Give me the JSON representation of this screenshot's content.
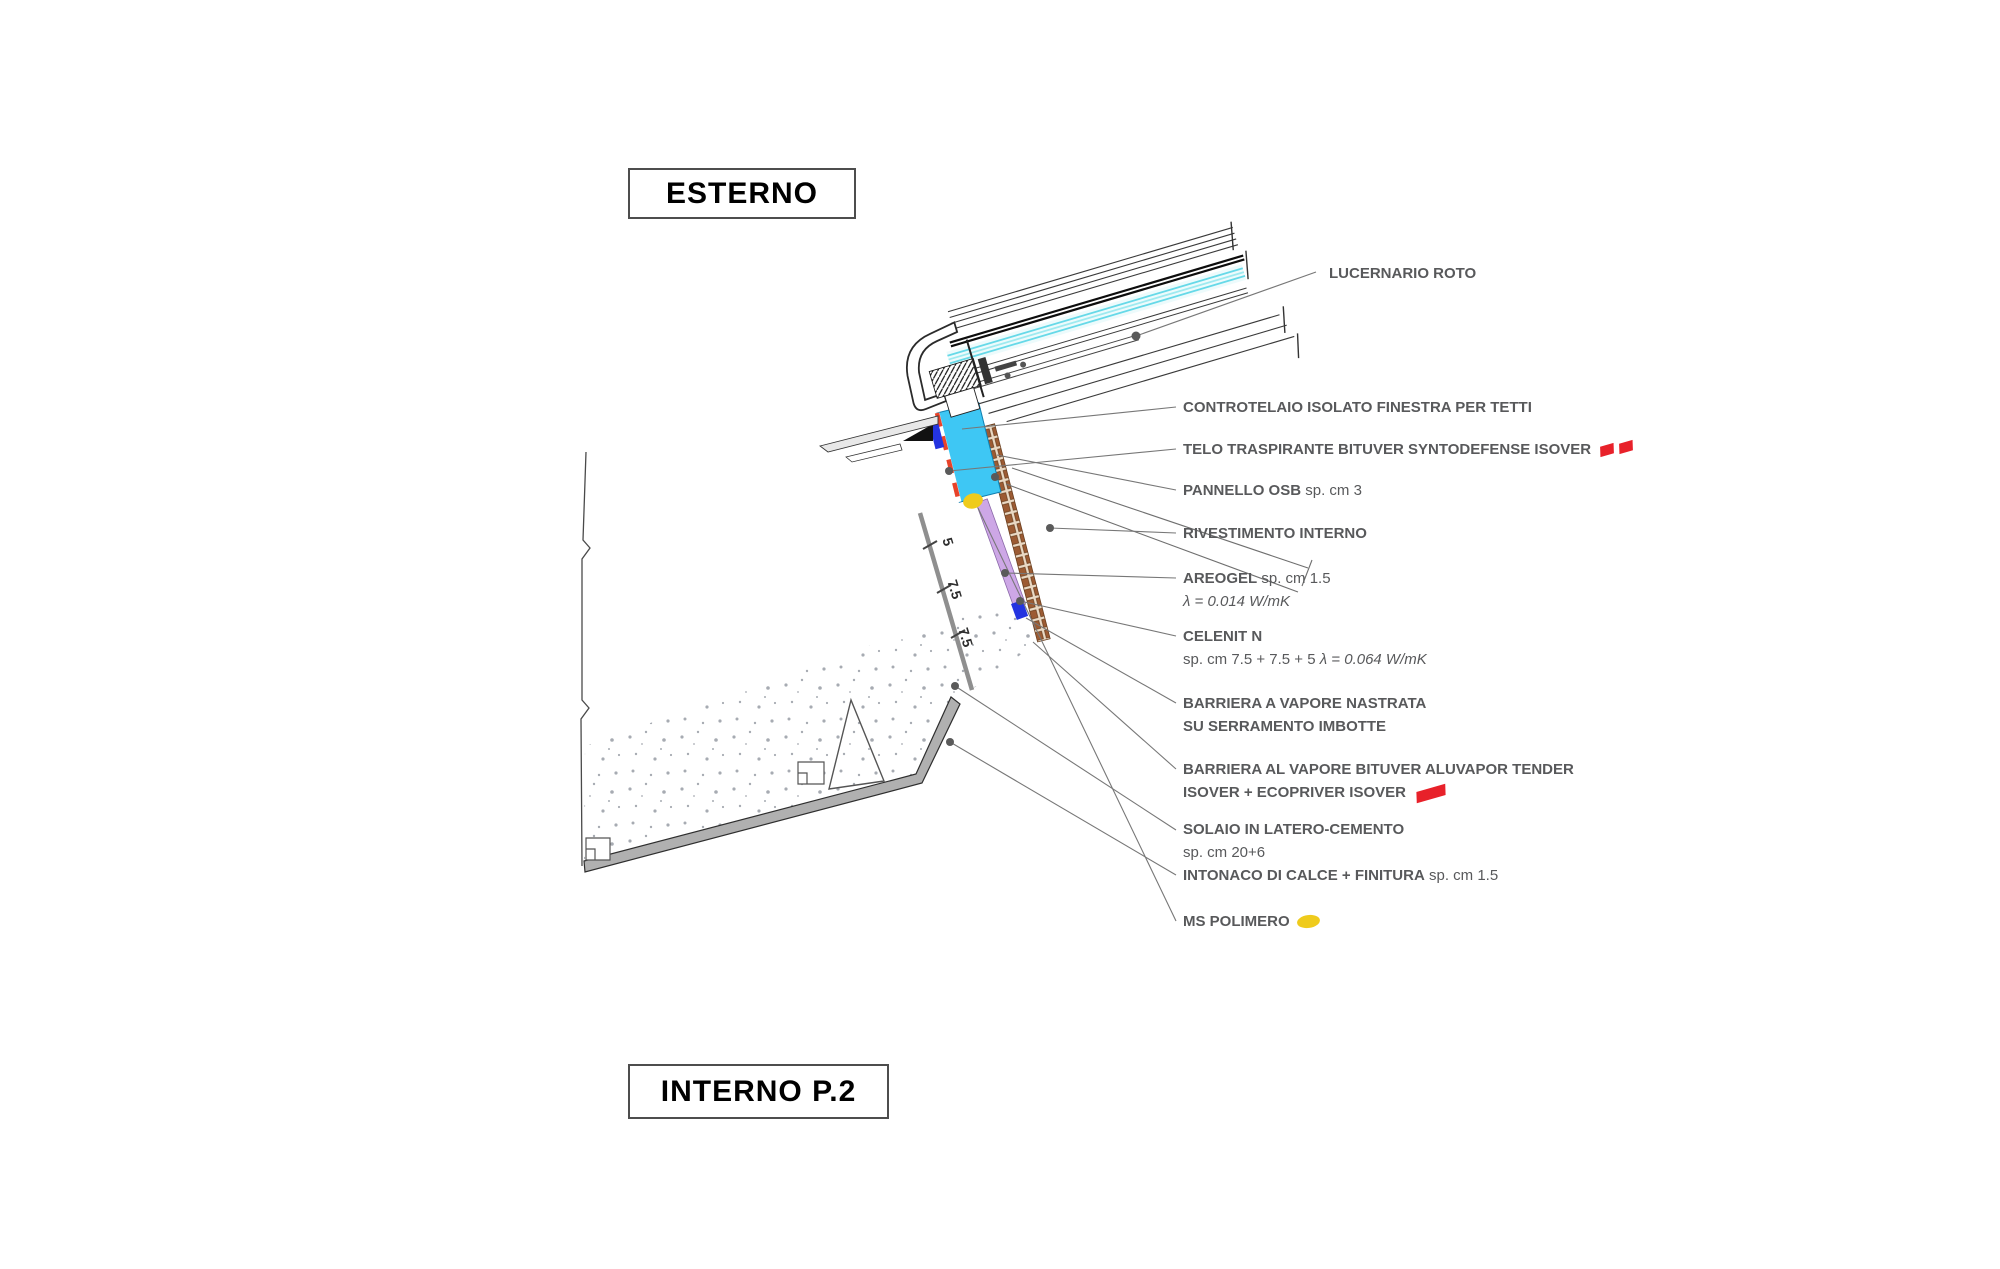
{
  "scene": {
    "exterior_label": "ESTERNO",
    "interior_label": "INTERNO P.2"
  },
  "labels": {
    "lucernario": {
      "text": "LUCERNARIO ROTO"
    },
    "controtelaio": {
      "text": "CONTROTELAIO ISOLATO FINESTRA PER TETTI"
    },
    "telo": {
      "text": "TELO TRASPIRANTE BITUVER SYNTODEFENSE ISOVER"
    },
    "pannello": {
      "bold": "PANNELLO OSB",
      "reg": " sp. cm 3"
    },
    "rivestimento": {
      "text": "RIVESTIMENTO INTERNO"
    },
    "areogel": {
      "bold": "AREOGEL",
      "reg": " sp. cm 1.5",
      "lambda": "λ = 0.014 W/mK"
    },
    "celenit": {
      "bold": "CELENIT N",
      "reg": "sp. cm 7.5 + 7.5 + 5 ",
      "lambda": "λ = 0.064 W/mK"
    },
    "barriera_nastrata": {
      "line1": "BARRIERA A VAPORE NASTRATA",
      "line2": "SU SERRAMENTO IMBOTTE"
    },
    "barriera_aluvapor": {
      "line1": "BARRIERA AL VAPORE BITUVER ALUVAPOR TENDER",
      "line2": "ISOVER + ECOPRIVER ISOVER"
    },
    "solaio": {
      "bold": "SOLAIO IN LATERO-CEMENTO",
      "reg": "sp. cm 20+6"
    },
    "intonaco": {
      "bold": "INTONACO DI CALCE + FINITURA",
      "reg": " sp. cm 1.5"
    },
    "ms_polimero": {
      "text": "MS POLIMERO"
    }
  },
  "dimensions": {
    "d1": "5",
    "d2": "7.5",
    "d3": "7.5"
  },
  "colors": {
    "label_text": "#58595B",
    "controtelaio_cyan": "#3EC7F4",
    "areogel_purple": "#CDA7E6",
    "ms_polimero_yellow": "#EFCB1C",
    "legend_red": "#E8212A",
    "vapour_barrier_red": "#CF0505",
    "membrane_dash_red": "#E8432A",
    "insulation_green": "#E6F0E3",
    "celenit_tan": "#ECC5AC",
    "block_grout_tan": "#F3CBA0",
    "tile_gray": "#ACACAC",
    "osb_brown": "#9C5B33",
    "marker_blue": "#2434E0"
  }
}
